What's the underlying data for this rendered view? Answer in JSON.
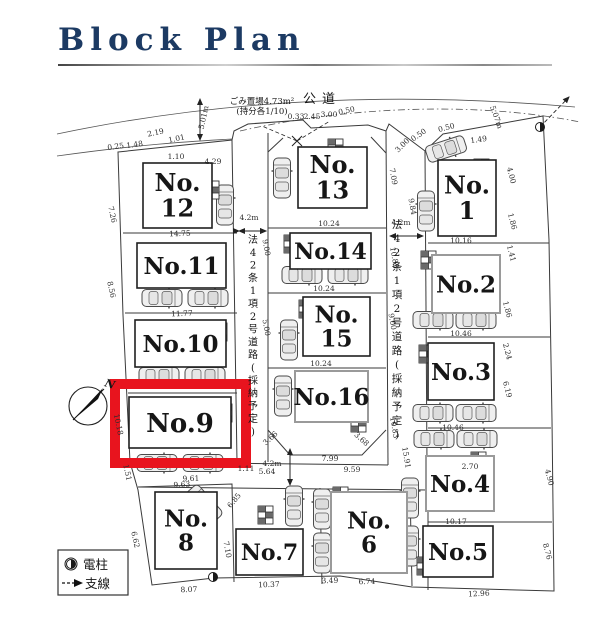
{
  "page": {
    "title": "Block Plan"
  },
  "legend": {
    "pole": "電柱",
    "wire": "支線"
  },
  "map": {
    "public_road": "公道",
    "garbage": "ごみ置場4.73m²",
    "garbage_share": "(持分各1/10)",
    "road_label": "法42条1項2号道路(採納予定)",
    "compass": "N",
    "highlight_color": "#e8141e",
    "highlight_lot": "No.9",
    "lots": [
      {
        "id": "1",
        "lines": [
          "No.",
          "1"
        ],
        "x": 438,
        "y": 160,
        "w": 58,
        "h": 76,
        "fs": 24,
        "gray": false
      },
      {
        "id": "2",
        "lines": [
          "No.2"
        ],
        "x": 432,
        "y": 255,
        "w": 68,
        "h": 58,
        "fs": 23,
        "gray": true
      },
      {
        "id": "3",
        "lines": [
          "No.3"
        ],
        "x": 428,
        "y": 343,
        "w": 66,
        "h": 57,
        "fs": 23,
        "gray": false
      },
      {
        "id": "4",
        "lines": [
          "No.4"
        ],
        "x": 426,
        "y": 456,
        "w": 68,
        "h": 55,
        "fs": 23,
        "gray": true
      },
      {
        "id": "5",
        "lines": [
          "No.5"
        ],
        "x": 423,
        "y": 526,
        "w": 70,
        "h": 51,
        "fs": 23,
        "gray": false
      },
      {
        "id": "6",
        "lines": [
          "No.",
          "6"
        ],
        "x": 331,
        "y": 492,
        "w": 76,
        "h": 81,
        "fs": 23,
        "gray": true
      },
      {
        "id": "7",
        "lines": [
          "No.7"
        ],
        "x": 236,
        "y": 529,
        "w": 67,
        "h": 46,
        "fs": 22,
        "gray": false
      },
      {
        "id": "8",
        "lines": [
          "No.",
          "8"
        ],
        "x": 155,
        "y": 492,
        "w": 62,
        "h": 77,
        "fs": 23,
        "gray": false
      },
      {
        "id": "9",
        "lines": [
          "No.9"
        ],
        "x": 129,
        "y": 397,
        "w": 102,
        "h": 51,
        "fs": 26,
        "gray": false
      },
      {
        "id": "10",
        "lines": [
          "No.10"
        ],
        "x": 135,
        "y": 320,
        "w": 91,
        "h": 47,
        "fs": 23,
        "gray": false
      },
      {
        "id": "11",
        "lines": [
          "No.11"
        ],
        "x": 137,
        "y": 243,
        "w": 89,
        "h": 45,
        "fs": 23,
        "gray": false
      },
      {
        "id": "12",
        "lines": [
          "No.",
          "12"
        ],
        "x": 143,
        "y": 163,
        "w": 69,
        "h": 65,
        "fs": 24,
        "gray": false
      },
      {
        "id": "13",
        "lines": [
          "No.",
          "13"
        ],
        "x": 298,
        "y": 147,
        "w": 69,
        "h": 61,
        "fs": 24,
        "gray": false
      },
      {
        "id": "14",
        "lines": [
          "No.14"
        ],
        "x": 290,
        "y": 233,
        "w": 81,
        "h": 36,
        "fs": 22,
        "gray": false
      },
      {
        "id": "15",
        "lines": [
          "No.",
          "15"
        ],
        "x": 303,
        "y": 297,
        "w": 67,
        "h": 59,
        "fs": 23,
        "gray": false
      },
      {
        "id": "16",
        "lines": [
          "No.16"
        ],
        "x": 295,
        "y": 371,
        "w": 73,
        "h": 51,
        "fs": 23,
        "gray": true
      }
    ],
    "road_width_arrows": [
      {
        "t": "4.2m",
        "x": 249,
        "y": 220,
        "r": 0,
        "s": 9.5
      },
      {
        "t": "4.2m",
        "x": 401,
        "y": 225,
        "r": 0,
        "s": 9.5
      },
      {
        "t": "4.2m",
        "x": 272,
        "y": 466,
        "r": 0,
        "s": 9.5
      }
    ],
    "dims": [
      {
        "t": "5.01m",
        "x": 206,
        "y": 118,
        "r": -78
      },
      {
        "t": "0.25",
        "x": 116,
        "y": 149,
        "r": -8
      },
      {
        "t": "1.48",
        "x": 135,
        "y": 147,
        "r": -8
      },
      {
        "t": "2.19",
        "x": 156,
        "y": 135,
        "r": -12
      },
      {
        "t": "1.01",
        "x": 177,
        "y": 141,
        "r": -12
      },
      {
        "t": "1.10",
        "x": 176,
        "y": 159,
        "r": 0
      },
      {
        "t": "4.29",
        "x": 213,
        "y": 164,
        "r": 0
      },
      {
        "t": "0.33",
        "x": 296,
        "y": 119,
        "r": 0
      },
      {
        "t": "2.45",
        "x": 312,
        "y": 119,
        "r": 0
      },
      {
        "t": "3.00",
        "x": 329,
        "y": 117,
        "r": 0
      },
      {
        "t": "0.50",
        "x": 347,
        "y": 113,
        "r": -12
      },
      {
        "t": "3.00",
        "x": 404,
        "y": 147,
        "r": -45
      },
      {
        "t": "0.50",
        "x": 420,
        "y": 137,
        "r": -35
      },
      {
        "t": "0.50",
        "x": 447,
        "y": 130,
        "r": -15
      },
      {
        "t": "1.49",
        "x": 479,
        "y": 142,
        "r": -8
      },
      {
        "t": "5.07m",
        "x": 494,
        "y": 118,
        "r": 70
      },
      {
        "t": "7.09",
        "x": 391,
        "y": 177,
        "r": 80
      },
      {
        "t": "9.84",
        "x": 410,
        "y": 207,
        "r": 80
      },
      {
        "t": "4.00",
        "x": 509,
        "y": 176,
        "r": 75
      },
      {
        "t": "1.86",
        "x": 510,
        "y": 222,
        "r": 75
      },
      {
        "t": "1.41",
        "x": 509,
        "y": 254,
        "r": 75
      },
      {
        "t": "1.86",
        "x": 505,
        "y": 310,
        "r": 75
      },
      {
        "t": "2.24",
        "x": 505,
        "y": 352,
        "r": 75
      },
      {
        "t": "6.19",
        "x": 505,
        "y": 390,
        "r": 75
      },
      {
        "t": "4.90",
        "x": 547,
        "y": 478,
        "r": 75
      },
      {
        "t": "8.76",
        "x": 545,
        "y": 552,
        "r": 75
      },
      {
        "t": "14.75",
        "x": 180,
        "y": 236,
        "r": -2
      },
      {
        "t": "11.77",
        "x": 182,
        "y": 316,
        "r": -2
      },
      {
        "t": "9.61",
        "x": 191,
        "y": 481,
        "r": -2
      },
      {
        "t": "7.26",
        "x": 110,
        "y": 215,
        "r": 78
      },
      {
        "t": "8.56",
        "x": 109,
        "y": 290,
        "r": 78
      },
      {
        "t": "10.18",
        "x": 116,
        "y": 425,
        "r": 78
      },
      {
        "t": "1.51",
        "x": 125,
        "y": 473,
        "r": 78
      },
      {
        "t": "6.62",
        "x": 133,
        "y": 540,
        "r": 78
      },
      {
        "t": "10.24",
        "x": 329,
        "y": 226,
        "r": 0
      },
      {
        "t": "10.24",
        "x": 324,
        "y": 291,
        "r": 0
      },
      {
        "t": "10.24",
        "x": 321,
        "y": 366,
        "r": 0
      },
      {
        "t": "7.99",
        "x": 330,
        "y": 461,
        "r": 0
      },
      {
        "t": "3.66",
        "x": 272,
        "y": 440,
        "r": -42
      },
      {
        "t": "3.68",
        "x": 360,
        "y": 441,
        "r": 42
      },
      {
        "t": "9.00",
        "x": 264,
        "y": 248,
        "r": 80
      },
      {
        "t": "5.00",
        "x": 264,
        "y": 328,
        "r": 80
      },
      {
        "t": "10.83",
        "x": 392,
        "y": 258,
        "r": 80
      },
      {
        "t": "9.00",
        "x": 390,
        "y": 322,
        "r": 80
      },
      {
        "t": "10.83",
        "x": 392,
        "y": 428,
        "r": 80
      },
      {
        "t": "1.11",
        "x": 246,
        "y": 471,
        "r": 0
      },
      {
        "t": "5.64",
        "x": 267,
        "y": 474,
        "r": 0
      },
      {
        "t": "9.59",
        "x": 352,
        "y": 472,
        "r": 0
      },
      {
        "t": "2.70",
        "x": 470,
        "y": 469,
        "r": 0
      },
      {
        "t": "15.91",
        "x": 404,
        "y": 458,
        "r": 80
      },
      {
        "t": "9.63",
        "x": 182,
        "y": 487,
        "r": -3
      },
      {
        "t": "7.10",
        "x": 225,
        "y": 550,
        "r": 80
      },
      {
        "t": "6.85",
        "x": 236,
        "y": 502,
        "r": -50
      },
      {
        "t": "8.07",
        "x": 189,
        "y": 592,
        "r": -2
      },
      {
        "t": "10.37",
        "x": 269,
        "y": 587,
        "r": -2
      },
      {
        "t": "3.49",
        "x": 330,
        "y": 583,
        "r": -2
      },
      {
        "t": "6.74",
        "x": 367,
        "y": 584,
        "r": -2
      },
      {
        "t": "12.96",
        "x": 479,
        "y": 596,
        "r": -3
      },
      {
        "t": "10.16",
        "x": 461,
        "y": 243,
        "r": 0
      },
      {
        "t": "10.46",
        "x": 461,
        "y": 336,
        "r": 0
      },
      {
        "t": "10.46",
        "x": 453,
        "y": 430,
        "r": 0
      },
      {
        "t": "10.17",
        "x": 456,
        "y": 524,
        "r": 0
      }
    ]
  }
}
